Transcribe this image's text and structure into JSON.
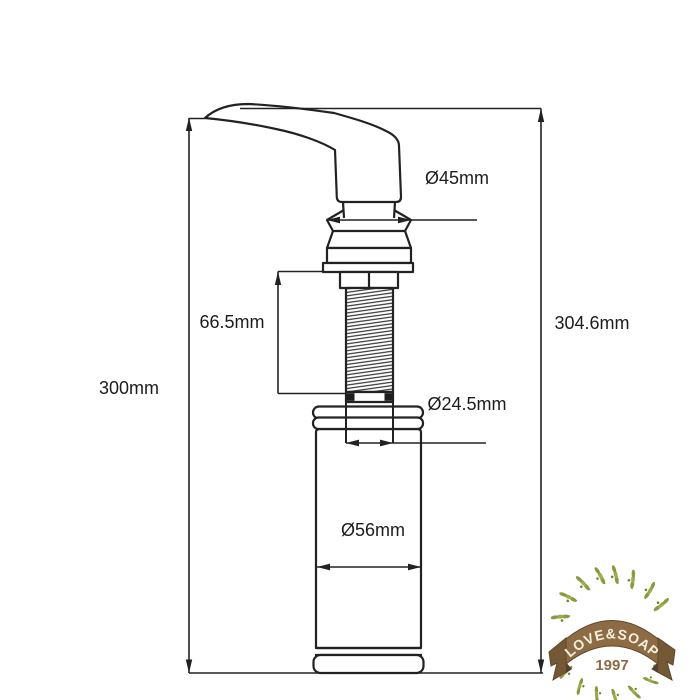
{
  "drawing": {
    "type": "technical-dimension-diagram",
    "subject": "kitchen sink soap dispenser pump with bottle",
    "dimensions": {
      "head_diameter": "Ø45mm",
      "thread_length": "66.5mm",
      "height_left": "300mm",
      "height_right": "304.6mm",
      "tube_diameter": "Ø24.5mm",
      "bottle_diameter": "Ø56mm"
    }
  },
  "logo": {
    "brand": "LOVE&SOAP",
    "year": "1997",
    "colors": {
      "ribbon": "#8d6b44",
      "ribbon_dark": "#755936",
      "ribbon_fold": "#54402a",
      "banner_text": "#f6f0dd",
      "year_text": "#8d6b44",
      "leaf": "#8a9a3e",
      "leaf_light": "#9dad4d",
      "stem": "#7d8d33"
    }
  },
  "colors": {
    "line": "#222222",
    "background": "#ffffff"
  }
}
